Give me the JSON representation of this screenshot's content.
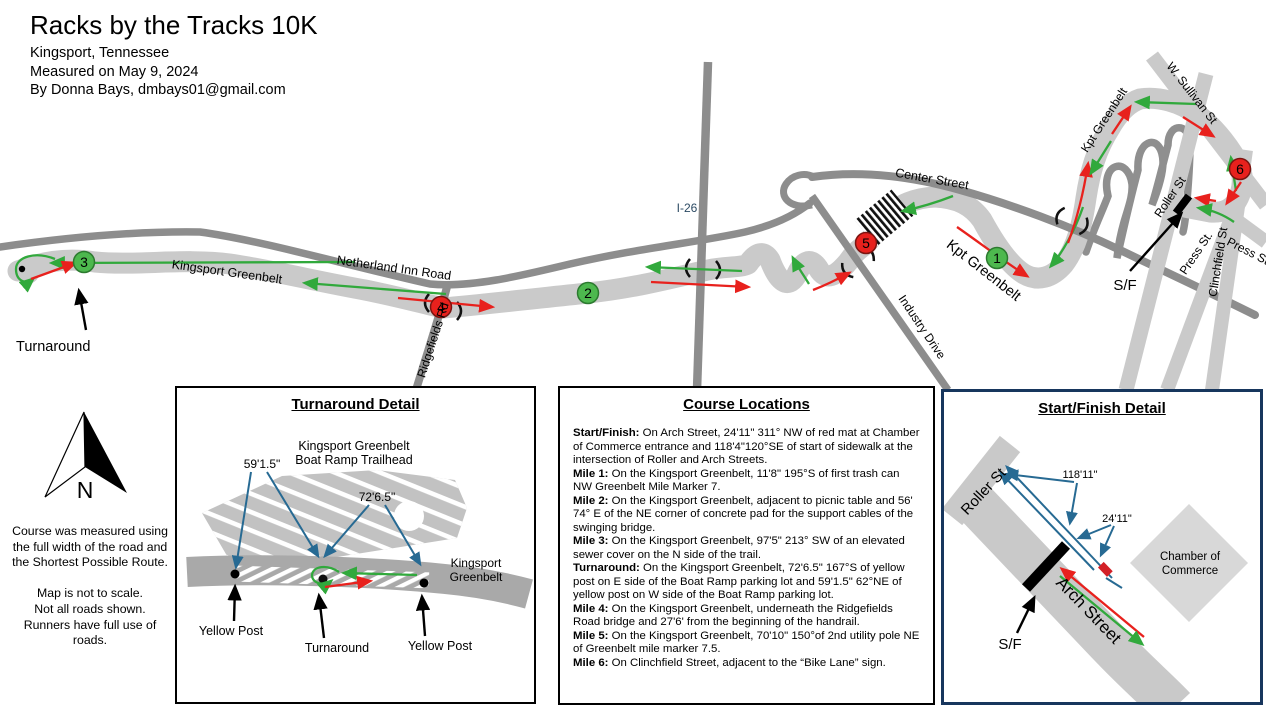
{
  "header": {
    "title": "Racks by the Tracks 10K",
    "city": "Kingsport, Tennessee",
    "measured": "Measured on May 9, 2024",
    "author": "By Donna Bays, dmbays01@gmail.com"
  },
  "colors": {
    "route_out_green": "#31a93c",
    "route_back_red": "#e8211d",
    "measurement_blue": "#276a93",
    "greenbelt_gray": "#cacaca",
    "road_gray": "#8d8d8d",
    "mile_marker_green": "#4db84e",
    "mile_marker_red": "#e8211d",
    "sf_detail_border_navy": "#17365d"
  },
  "map": {
    "labels": {
      "kingsport_greenbelt": "Kingsport Greenbelt",
      "netherland_inn_road": "Netherland Inn Road",
      "ridgefields_rd": "Ridgefields Rd",
      "i26": "I-26",
      "center_street": "Center Street",
      "industry_drive": "Industry Drive",
      "kpt_greenbelt_mid": "Kpt Greenbelt",
      "kpt_greenbelt_right": "Kpt Greenbelt",
      "w_sullivan_st": "W. Sullivan St",
      "roller_st": "Roller St",
      "press_st_left": "Press St.",
      "clinchfield_st": "Clinchfield St",
      "press_st_right": "Press St",
      "sf": "S/F",
      "turnaround": "Turnaround"
    },
    "markers": {
      "m1": {
        "label": "1",
        "color": "green"
      },
      "m2": {
        "label": "2",
        "color": "green"
      },
      "m3": {
        "label": "3",
        "color": "green"
      },
      "m4": {
        "label": "4",
        "color": "red"
      },
      "m5": {
        "label": "5",
        "color": "red"
      },
      "m6": {
        "label": "6",
        "color": "red"
      }
    }
  },
  "compass": {
    "n": "N"
  },
  "notes": {
    "block1": [
      "Course was measured using",
      "the full width of the road and",
      "the Shortest Possible Route."
    ],
    "block2": [
      "Map is not to scale.",
      "Not all roads shown.",
      "Runners have full use of",
      "roads."
    ]
  },
  "turnaround_detail": {
    "title": "Turnaround Detail",
    "trailhead_line1": "Kingsport Greenbelt",
    "trailhead_line2": "Boat Ramp Trailhead",
    "measurement_west": "59'1.5\"",
    "measurement_east": "72'6.5\"",
    "greenbelt_line1": "Kingsport",
    "greenbelt_line2": "Greenbelt",
    "yellow_post_left": "Yellow Post",
    "turnaround_label": "Turnaround",
    "yellow_post_right": "Yellow Post"
  },
  "course_locations": {
    "title": "Course Locations",
    "items": [
      {
        "label": "Start/Finish:",
        "text": "On Arch Street, 24'11\" 311° NW of red mat at Chamber of Commerce entrance and 118'4\"120°SE of start of sidewalk at the intersection of Roller  and Arch Streets."
      },
      {
        "label": "Mile 1:",
        "text": "On the Kingsport Greenbelt, 11'8\" 195°S of first trash can NW Greenbelt Mile Marker 7."
      },
      {
        "label": "Mile 2:",
        "text": "On the Kingsport Greenbelt, adjacent to picnic table and 56' 74° E of the NE corner of concrete pad for the support cables of the swinging bridge."
      },
      {
        "label": "Mile 3:",
        "text": "On the Kingsport Greenbelt, 97'5\" 213° SW of an elevated sewer cover on the N side of the trail."
      },
      {
        "label": "Turnaround:",
        "text": "On the Kingsport Greenbelt, 72'6.5\" 167°S of yellow post on E side of the Boat Ramp parking lot and 59'1.5\" 62°NE of yellow post on W side of the Boat Ramp parking lot."
      },
      {
        "label": "Mile 4:",
        "text": "On the Kingsport Greenbelt, underneath the Ridgefields Road bridge and 27'6' from the beginning of the handrail."
      },
      {
        "label": "Mile 5:",
        "text": "On the Kingsport Greenbelt, 70'10\" 150°of 2nd utility pole NE of Greenbelt mile marker 7.5."
      },
      {
        "label": "Mile 6:",
        "text": "On Clinchfield Street, adjacent to the “Bike Lane” sign."
      }
    ]
  },
  "sf_detail": {
    "title": "Start/Finish Detail",
    "roller_st": "Roller St",
    "arch_street": "Arch Street",
    "measurement_long": "118'11\"",
    "measurement_short": "24'11\"",
    "chamber_line1": "Chamber of",
    "chamber_line2": "Commerce",
    "sf": "S/F"
  }
}
